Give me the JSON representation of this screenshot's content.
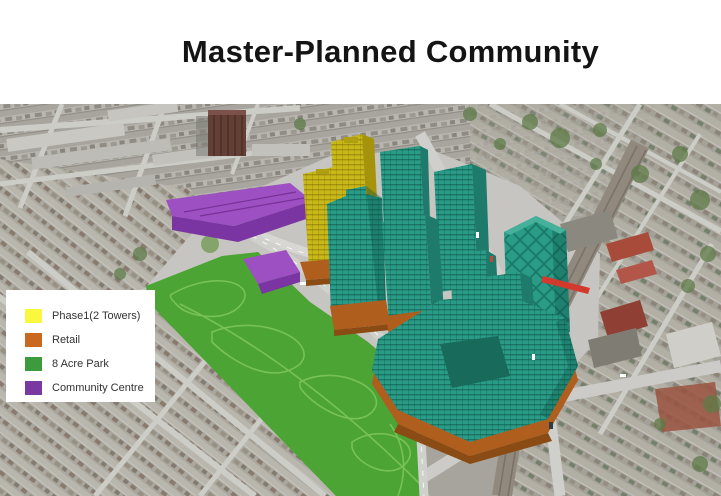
{
  "title": "Master-Planned Community",
  "legend": {
    "items": [
      {
        "label": "Phase1(2 Towers)",
        "color": "#F9F73E"
      },
      {
        "label": "Retail",
        "color": "#C8691F"
      },
      {
        "label": "8 Acre Park",
        "color": "#3D9B3D"
      },
      {
        "label": "Community Centre",
        "color": "#7939A1"
      }
    ]
  },
  "colors": {
    "park": "#4BA434",
    "park-path": "#7DC55C",
    "teal": "#2A9B87",
    "teal-dark": "#1E7A6A",
    "teal-top": "#46B19B",
    "yellow": "#C9B81A",
    "yellow-dark": "#A5930C",
    "orange": "#B05E1D",
    "orange-dark": "#8A4C14",
    "purple": "#9D50C2",
    "purple-dark": "#7B35A2",
    "train-red": "#D23A2E"
  }
}
